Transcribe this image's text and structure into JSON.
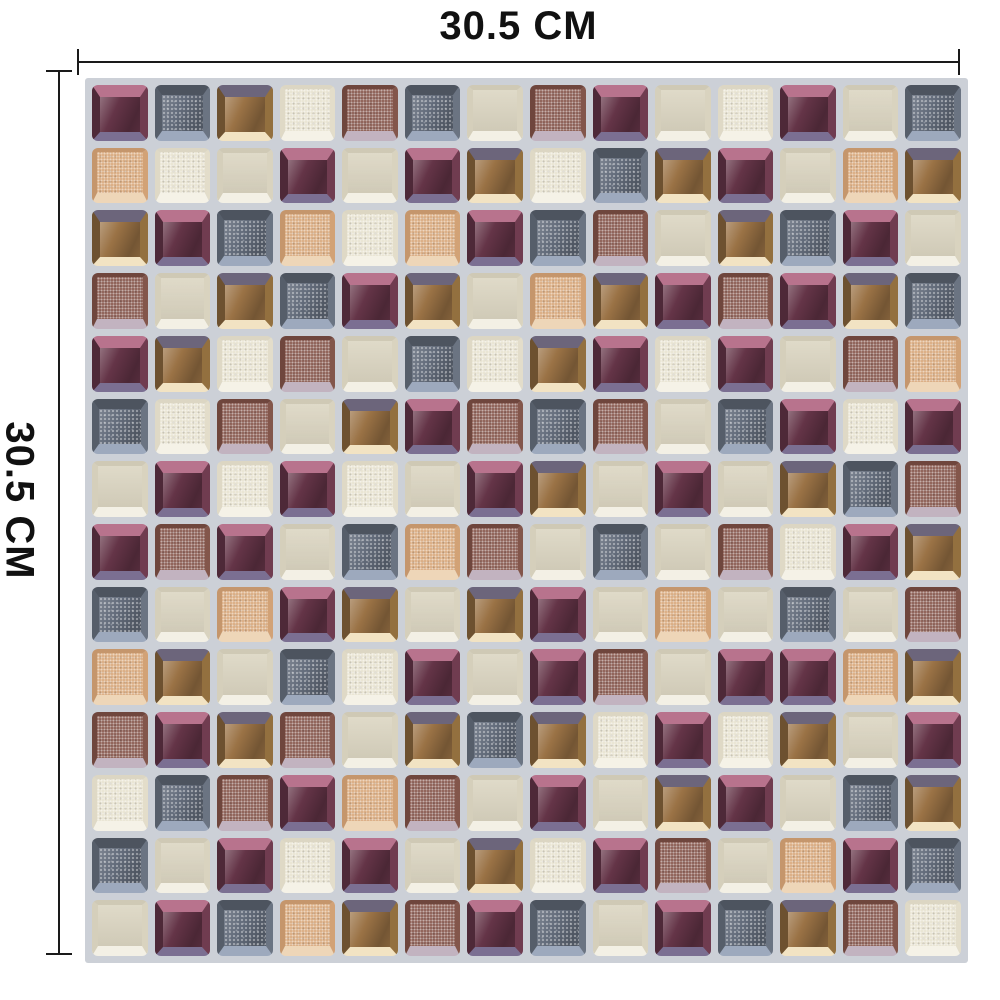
{
  "diagram": {
    "width_label": "30.5 CM",
    "height_label": "30.5 CM",
    "line_color": "#1a1a1a",
    "page_background": "#ffffff"
  },
  "mosaic": {
    "description": "square mosaic tile sticker sheet",
    "grout_color": "#ccd0d7",
    "rows": 14,
    "cols": 14,
    "grid": [
      "PBGCRBERPECPEB",
      "SCEPEPGCBGPESG",
      "GPBSCSPBREGBPE",
      "REGBPGESGPRPGB",
      "PGCREBCGPCPERS",
      "BCREGPRBREBPCP",
      "EPCPCEPGEPEGBR",
      "PRPEBSREBERCPG",
      "BESPGEGPESEBER",
      "SGEBCPEPREPPSG",
      "RPGREGBGCPCGEP",
      "CBRPSREPEGPEBG",
      "BEPCPEGCPRESPB",
      "EPBSGRPBEPBGRC"
    ],
    "palette": {
      "P": {
        "name": "plum-glass",
        "face": "#643447",
        "top": "#b8738d",
        "right": "#703c50",
        "bottom": "#7b6f92",
        "left": "#4e2938",
        "finish": "glossy"
      },
      "B": {
        "name": "slate-blue-speckled",
        "face": "#636c7b",
        "top": "#4d545f",
        "right": "#6b7482",
        "bottom": "#9da9bd",
        "left": "#565e6a",
        "finish": "glossy-speckled"
      },
      "G": {
        "name": "amber-glass",
        "face": "#9a7245",
        "top": "#6c657b",
        "right": "#93703f",
        "bottom": "#f2e3c3",
        "left": "#6d5130",
        "finish": "glossy"
      },
      "C": {
        "name": "ivory-speckled",
        "face": "#e9e4d2",
        "top": "#dcd6c3",
        "right": "#e3ddca",
        "bottom": "#f5f2e7",
        "left": "#dfd9c6",
        "finish": "textured"
      },
      "E": {
        "name": "plain-beige",
        "face": "#dbd5c1",
        "top": "#cfc9b5",
        "right": "#d9d3bf",
        "bottom": "#f3f0e5",
        "left": "#d5cfbb",
        "finish": "smooth"
      },
      "R": {
        "name": "rust-brown-speckled",
        "face": "#8b5c52",
        "top": "#6f463d",
        "right": "#83564b",
        "bottom": "#c2b3c0",
        "left": "#6f463d",
        "finish": "textured"
      },
      "S": {
        "name": "sand-speckled",
        "face": "#daab80",
        "top": "#c5966c",
        "right": "#d2a276",
        "bottom": "#eed6b8",
        "left": "#c5966c",
        "finish": "textured"
      }
    }
  }
}
